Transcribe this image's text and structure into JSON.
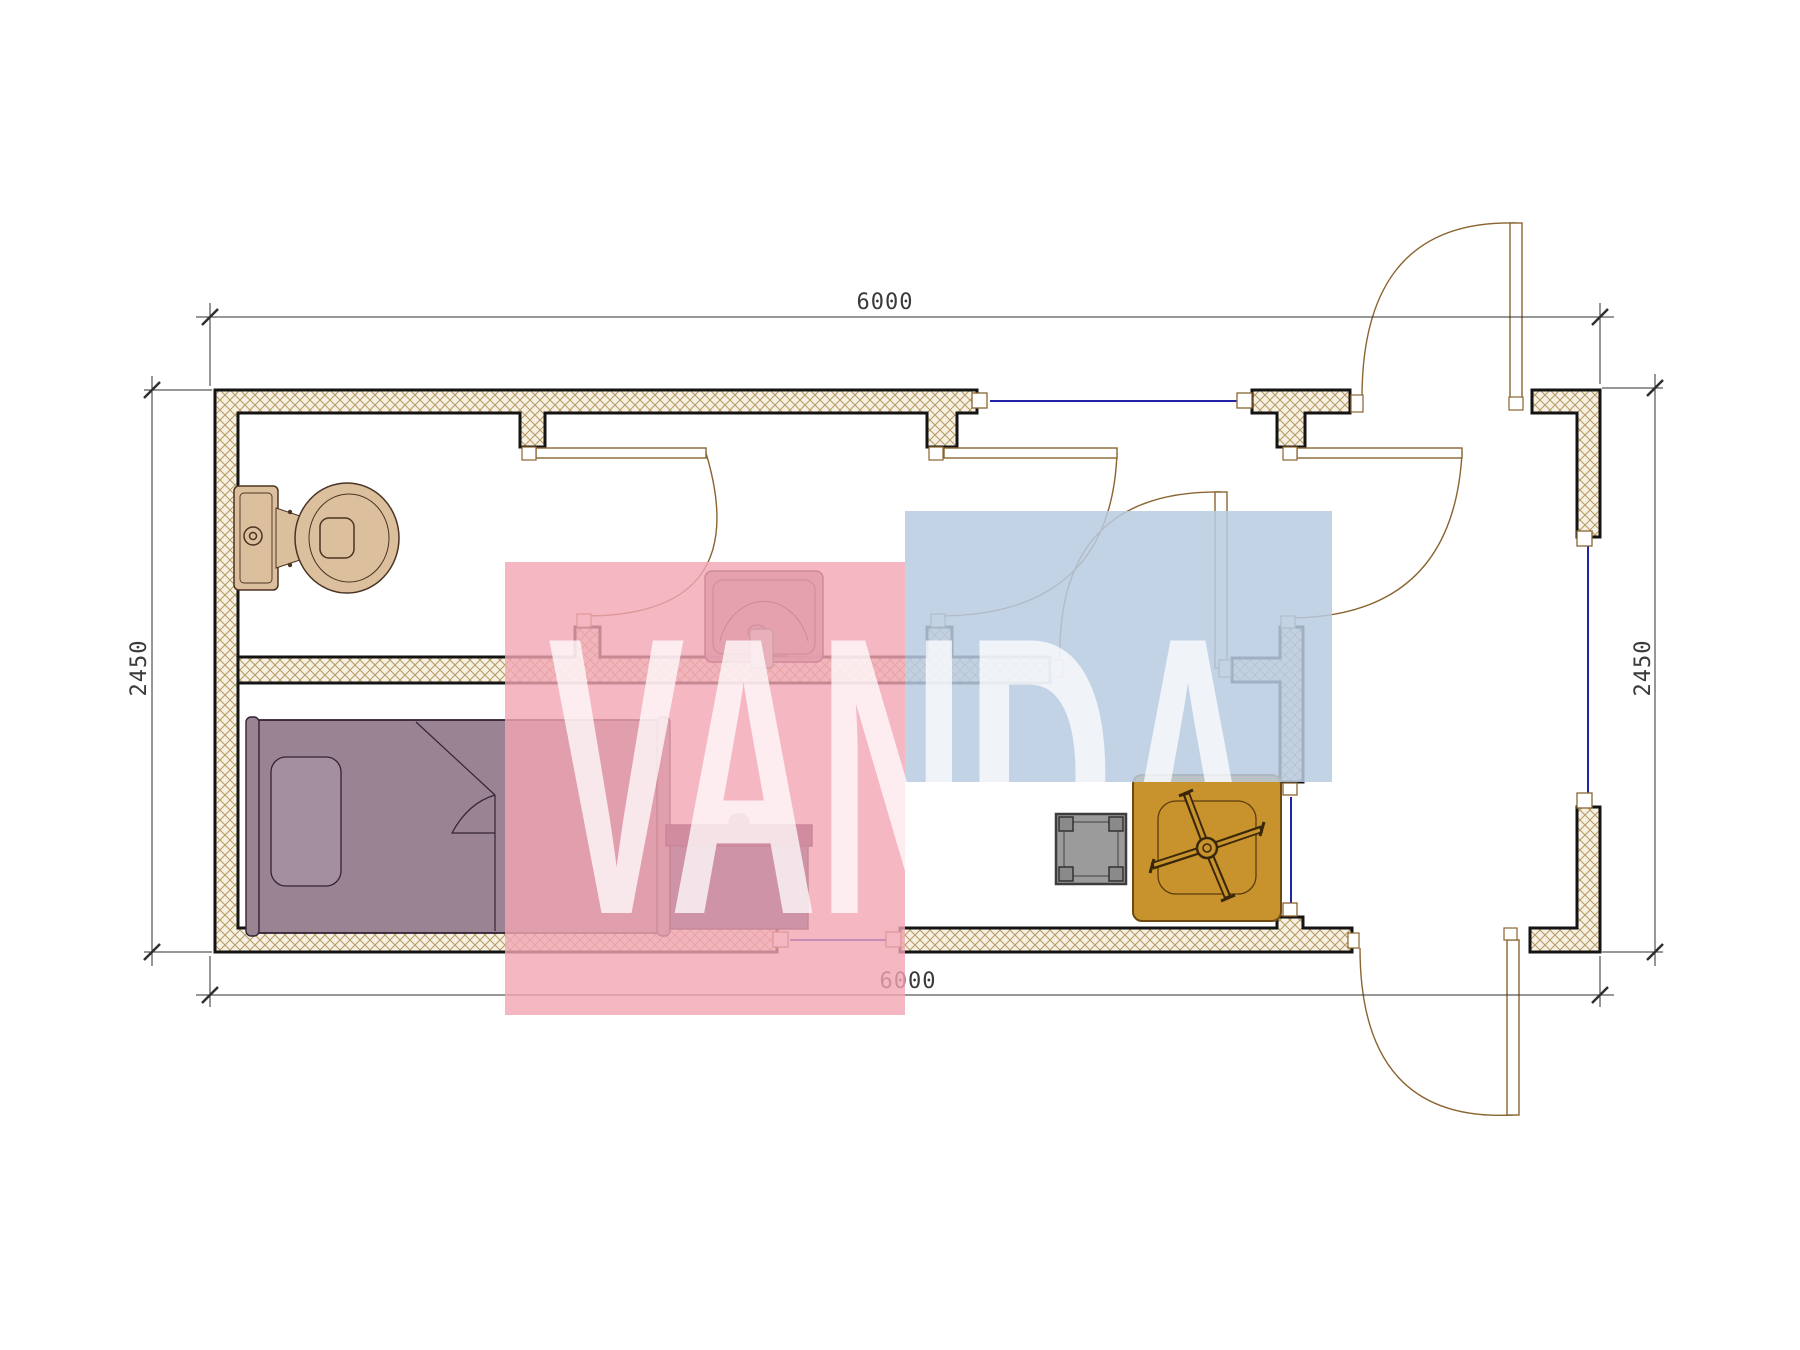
{
  "page": {
    "title": "Container house floor plan 6000 x 2450"
  },
  "dims": {
    "top": {
      "label": "6000"
    },
    "bottom": {
      "label": "6000"
    },
    "left": {
      "label": "2450"
    },
    "right": {
      "label": "2450"
    }
  },
  "watermark": {
    "text": "VANDA",
    "pink_color": "#f3a6b4",
    "blue_color": "#b9cbe2",
    "text_color": "#ffffff"
  },
  "plan": {
    "wall_fill": "#f6f1e2",
    "hatch_color": "#b59a62",
    "wall_stroke": "#141414",
    "window_color": "#2323a8",
    "door_color": "#8a6430",
    "dimension_color": "#3a3a3a",
    "furniture": [
      {
        "id": "toilet",
        "color": "#dcc09e"
      },
      {
        "id": "wash-basin",
        "color": "#a9838f"
      },
      {
        "id": "single-bed",
        "color": "#9a8494"
      },
      {
        "id": "cabinet",
        "color": "#3e4571"
      },
      {
        "id": "stool",
        "color": "#9b9b9b"
      },
      {
        "id": "table",
        "color": "#c8932c"
      }
    ],
    "windows_count": 4,
    "doors_count": 6
  }
}
